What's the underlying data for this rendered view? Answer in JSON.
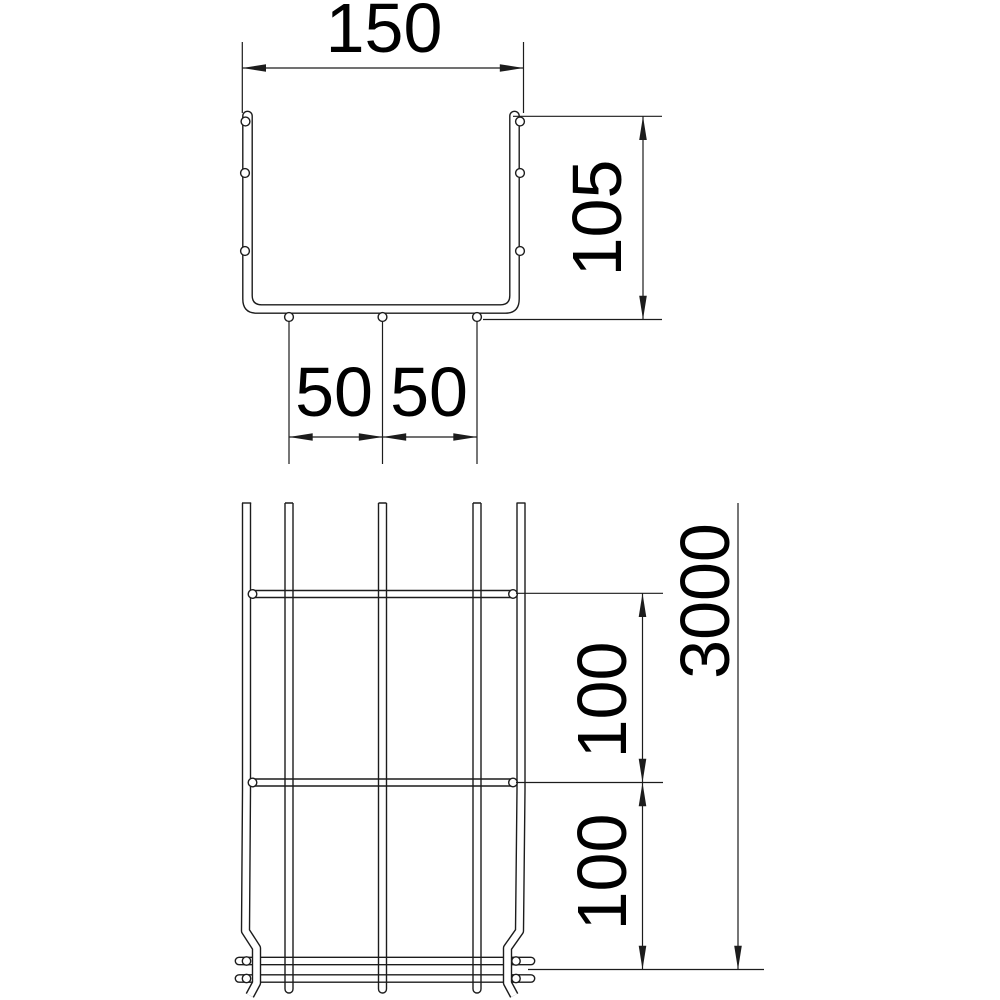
{
  "colors": {
    "background": "#ffffff",
    "line": "#1c1c1c",
    "text": "#000000"
  },
  "cross_section_view": {
    "width_label": "150",
    "height_label": "105",
    "bottom_wire_spacing_labels": [
      "50",
      "50"
    ]
  },
  "side_view": {
    "rung_spacing_labels": [
      "100",
      "100"
    ],
    "length_label": "3000"
  }
}
